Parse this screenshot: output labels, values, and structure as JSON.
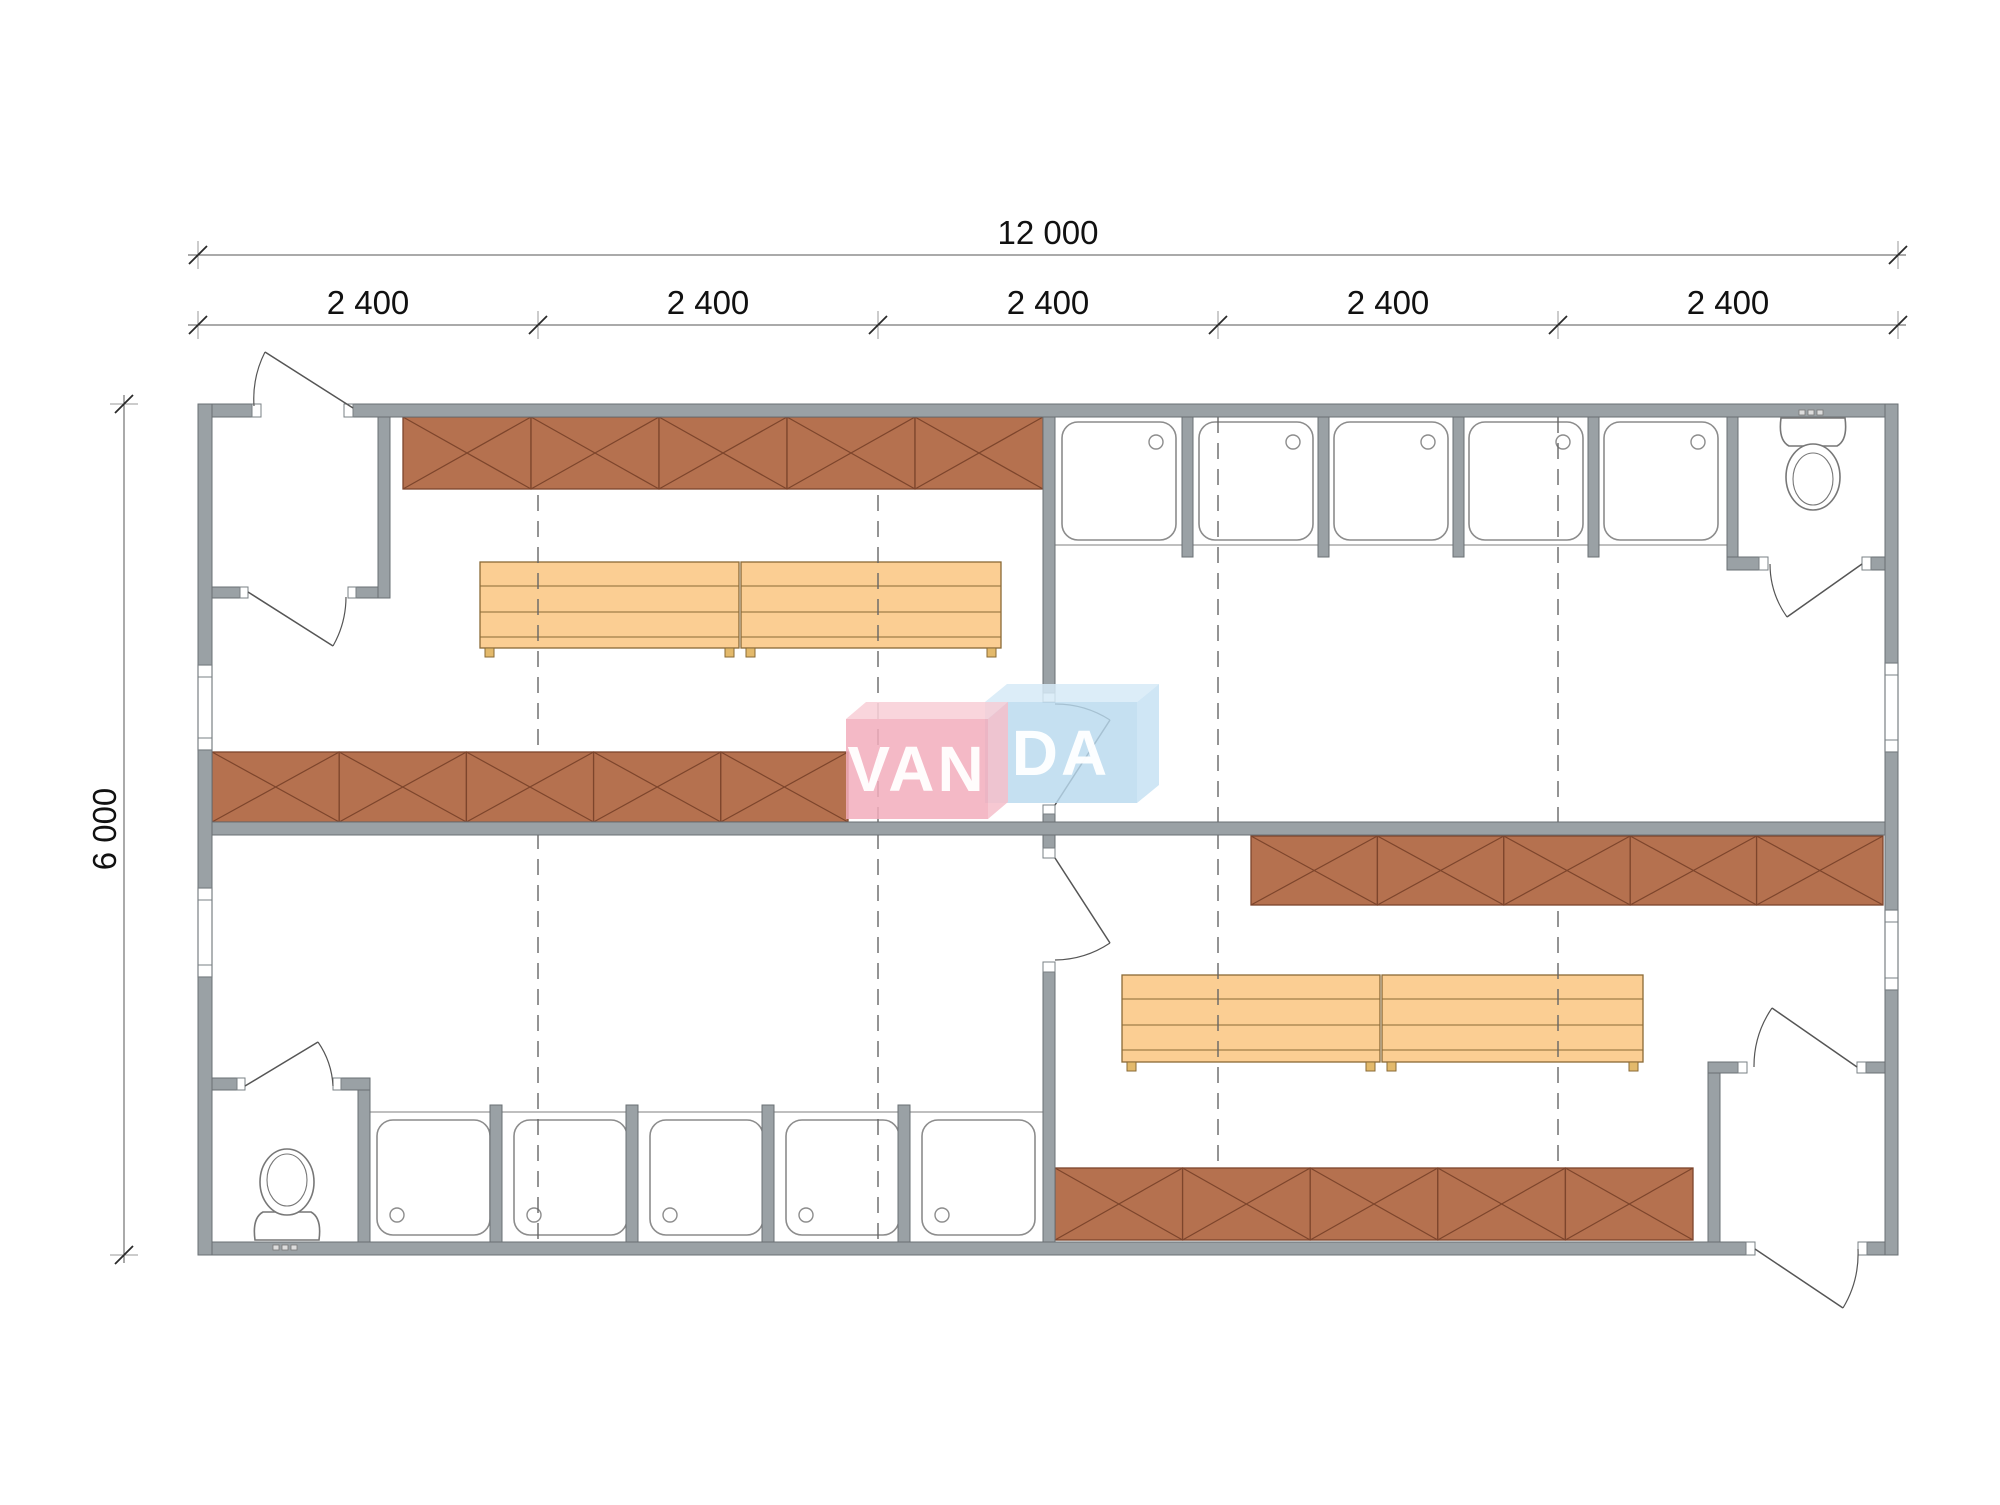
{
  "watermark": {
    "left_text": "VAN",
    "right_text": "DA",
    "pink_front": "rgba(242,173,188,0.85)",
    "pink_top": "rgba(248,207,215,0.88)",
    "pink_side": "rgba(245,190,202,0.85)",
    "blue_front": "rgba(184,217,238,0.82)",
    "blue_top": "rgba(214,234,247,0.85)",
    "blue_side": "rgba(199,226,243,0.85)",
    "text_color": "rgba(255,255,255,0.95)"
  },
  "dimensions": {
    "total_width": "12 000",
    "modules": [
      "2 400",
      "2 400",
      "2 400",
      "2 400",
      "2 400"
    ],
    "height": "6 000"
  },
  "colors": {
    "wall_fill": "#9aa1a5",
    "wall_stroke": "#6a7074",
    "locker_fill": "#b5714f",
    "locker_stroke": "#7d452c",
    "bench_fill": "#fbce93",
    "bench_stroke": "#8a6a36",
    "bench_foot": "#e3b96b",
    "tray_stroke": "#8c8c8c",
    "front_line": "#aaaaaa",
    "fixture_stroke": "#777777",
    "door_stroke": "#555555",
    "dashed_stroke": "#666666",
    "dim_line": "#555555",
    "dim_tick": "#2a2a2a",
    "jamb_fill": "#ffffff",
    "jamb_stroke": "#7a8084"
  },
  "plan": {
    "canvas": {
      "w": 2000,
      "h": 1505
    },
    "walls": [
      [
        198,
        404,
        54,
        13
      ],
      [
        353,
        404,
        1545,
        13
      ],
      [
        198,
        1242,
        1557,
        13
      ],
      [
        1858,
        1242,
        40,
        13
      ],
      [
        198,
        404,
        14,
        261
      ],
      [
        198,
        750,
        14,
        138
      ],
      [
        198,
        977,
        14,
        278
      ],
      [
        1885,
        404,
        13,
        259
      ],
      [
        1885,
        752,
        13,
        158
      ],
      [
        1885,
        990,
        13,
        265
      ],
      [
        212,
        822,
        1673,
        13
      ],
      [
        378,
        417,
        12,
        181
      ],
      [
        212,
        587,
        28,
        11
      ],
      [
        356,
        587,
        22,
        11
      ],
      [
        1043,
        417,
        12,
        285
      ],
      [
        1043,
        805,
        12,
        17
      ],
      [
        1727,
        417,
        11,
        153
      ],
      [
        1727,
        557,
        41,
        13
      ],
      [
        1862,
        557,
        23,
        13
      ],
      [
        1182,
        417,
        11,
        140
      ],
      [
        1318,
        417,
        11,
        140
      ],
      [
        1453,
        417,
        11,
        140
      ],
      [
        1588,
        417,
        11,
        140
      ],
      [
        1043,
        835,
        12,
        13
      ],
      [
        1043,
        972,
        12,
        270
      ],
      [
        358,
        1090,
        12,
        152
      ],
      [
        212,
        1078,
        26,
        12
      ],
      [
        341,
        1078,
        29,
        12
      ],
      [
        490,
        1105,
        12,
        137
      ],
      [
        626,
        1105,
        12,
        137
      ],
      [
        762,
        1105,
        12,
        137
      ],
      [
        898,
        1105,
        12,
        137
      ],
      [
        1708,
        1073,
        12,
        169
      ],
      [
        1708,
        1062,
        39,
        11
      ],
      [
        1857,
        1062,
        28,
        11
      ]
    ],
    "windows": [
      [
        198,
        665,
        14,
        85
      ],
      [
        198,
        888,
        14,
        89
      ],
      [
        1885,
        663,
        13,
        89
      ],
      [
        1885,
        910,
        13,
        80
      ]
    ],
    "jambs": [
      [
        252,
        404,
        9,
        13
      ],
      [
        344,
        404,
        9,
        13
      ],
      [
        240,
        587,
        8,
        11
      ],
      [
        348,
        587,
        8,
        11
      ],
      [
        1043,
        693,
        12,
        9
      ],
      [
        1043,
        805,
        12,
        9
      ],
      [
        1759,
        557,
        9,
        13
      ],
      [
        1862,
        557,
        9,
        13
      ],
      [
        1043,
        848,
        12,
        10
      ],
      [
        1043,
        962,
        12,
        10
      ],
      [
        237,
        1078,
        8,
        12
      ],
      [
        333,
        1078,
        8,
        12
      ],
      [
        1738,
        1062,
        9,
        11
      ],
      [
        1857,
        1062,
        9,
        11
      ],
      [
        1746,
        1242,
        9,
        13
      ],
      [
        1858,
        1242,
        9,
        13
      ]
    ],
    "lockers": [
      {
        "x": 403,
        "y": 417,
        "w": 640,
        "h": 72,
        "sections": 5
      },
      {
        "x": 212,
        "y": 752,
        "w": 636,
        "h": 70,
        "sections": 5
      },
      {
        "x": 1251,
        "y": 836,
        "w": 632,
        "h": 69,
        "sections": 5
      },
      {
        "x": 1055,
        "y": 1168,
        "w": 638,
        "h": 72,
        "sections": 5
      }
    ],
    "benches": [
      [
        480,
        562,
        259,
        86
      ],
      [
        741,
        562,
        260,
        86
      ],
      [
        1122,
        975,
        258,
        87
      ],
      [
        1382,
        975,
        261,
        87
      ]
    ],
    "shower_rows": [
      {
        "trays": [
          [
            1062,
            422,
            114,
            118
          ],
          [
            1199,
            422,
            114,
            118
          ],
          [
            1334,
            422,
            114,
            118
          ],
          [
            1469,
            422,
            114,
            118
          ],
          [
            1604,
            422,
            114,
            118
          ]
        ],
        "drain": "tr",
        "front": [
          1055,
          545,
          1727
        ]
      },
      {
        "trays": [
          [
            377,
            1120,
            113,
            115
          ],
          [
            514,
            1120,
            113,
            115
          ],
          [
            650,
            1120,
            113,
            115
          ],
          [
            786,
            1120,
            113,
            115
          ],
          [
            922,
            1120,
            113,
            115
          ]
        ],
        "drain": "bl",
        "front": [
          370,
          1112,
          1043
        ]
      }
    ],
    "toilets": [
      {
        "tank": "M1781,418 L1845,418 Q1848,440 1837,446 L1789,446 Q1778,440 1781,418 Z",
        "bowl": [
          1813,
          477,
          27,
          33
        ],
        "inner": [
          1813,
          479,
          20,
          26
        ],
        "dashes_y": 410,
        "dashes_x": [
          1799,
          1808,
          1817
        ]
      },
      {
        "tank": "M255,1240 L319,1240 Q322,1218 311,1212 L263,1212 Q252,1218 255,1240 Z",
        "bowl": [
          287,
          1182,
          27,
          33
        ],
        "inner": [
          287,
          1180,
          20,
          26
        ],
        "dashes_y": 1245,
        "dashes_x": [
          273,
          282,
          291
        ]
      }
    ],
    "doors": [
      {
        "leaf": [
          353,
          408,
          265,
          352
        ],
        "arc": "M265,352 A104,104 0 0 0 254,406"
      },
      {
        "leaf": [
          248,
          592,
          333,
          646
        ],
        "arc": "M333,646 A100,100 0 0 0 346,597"
      },
      {
        "leaf": [
          1055,
          805,
          1110,
          720
        ],
        "arc": "M1110,720 A101,101 0 0 0 1055,704"
      },
      {
        "leaf": [
          1862,
          564,
          1787,
          617
        ],
        "arc": "M1787,617 A92,92 0 0 1 1770,564"
      },
      {
        "leaf": [
          1055,
          858,
          1110,
          943
        ],
        "arc": "M1110,943 A101,101 0 0 1 1055,960"
      },
      {
        "leaf": [
          245,
          1086,
          318,
          1042
        ],
        "arc": "M318,1042 A85,85 0 0 1 333,1086"
      },
      {
        "leaf": [
          1857,
          1067,
          1772,
          1008
        ],
        "arc": "M1772,1008 A103,103 0 0 0 1754,1067"
      },
      {
        "leaf": [
          1755,
          1249,
          1843,
          1308
        ],
        "arc": "M1843,1308 A106,106 0 0 0 1858,1249"
      }
    ],
    "dashed_lines": [
      {
        "x": 538,
        "y1": 417,
        "y2": 1242
      },
      {
        "x": 878,
        "y1": 417,
        "y2": 1242
      },
      {
        "x": 1218,
        "y1": 417,
        "y2": 1242
      },
      {
        "x": 1558,
        "y1": 417,
        "y2": 1242
      }
    ],
    "dim_lines": {
      "h": [
        {
          "y": 255,
          "x1": 188,
          "x2": 1906,
          "ticks": [
            198,
            1898
          ]
        },
        {
          "y": 325,
          "x1": 188,
          "x2": 1906,
          "ticks": [
            198,
            538,
            878,
            1218,
            1558,
            1898
          ]
        }
      ],
      "v": [
        {
          "x": 124,
          "y1": 395,
          "y2": 1263,
          "ticks": [
            404,
            1255
          ]
        }
      ]
    }
  }
}
